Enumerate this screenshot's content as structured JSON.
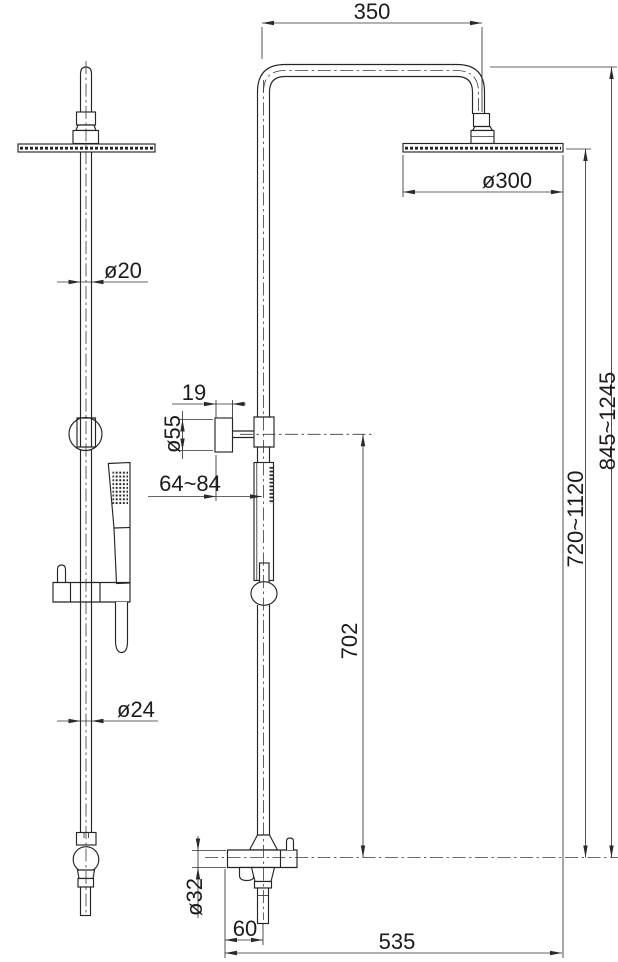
{
  "drawing": {
    "background": "#ffffff",
    "line_color": "#252525",
    "dimension_color": "#1b1b1b",
    "dimensions": {
      "arm_projection": "350",
      "head_diameter": "ø300",
      "upper_pipe_diameter": "ø20",
      "holder_depth": "19",
      "holder_knob_diameter": "ø55",
      "wall_distance": "64~84",
      "riser_height": "702",
      "head_height_range": "720~1120",
      "overall_height_range": "845~1245",
      "lower_pipe_diameter": "ø24",
      "mixer_body_diameter": "ø32",
      "outlet_offset": "60",
      "overall_width": "535"
    }
  }
}
